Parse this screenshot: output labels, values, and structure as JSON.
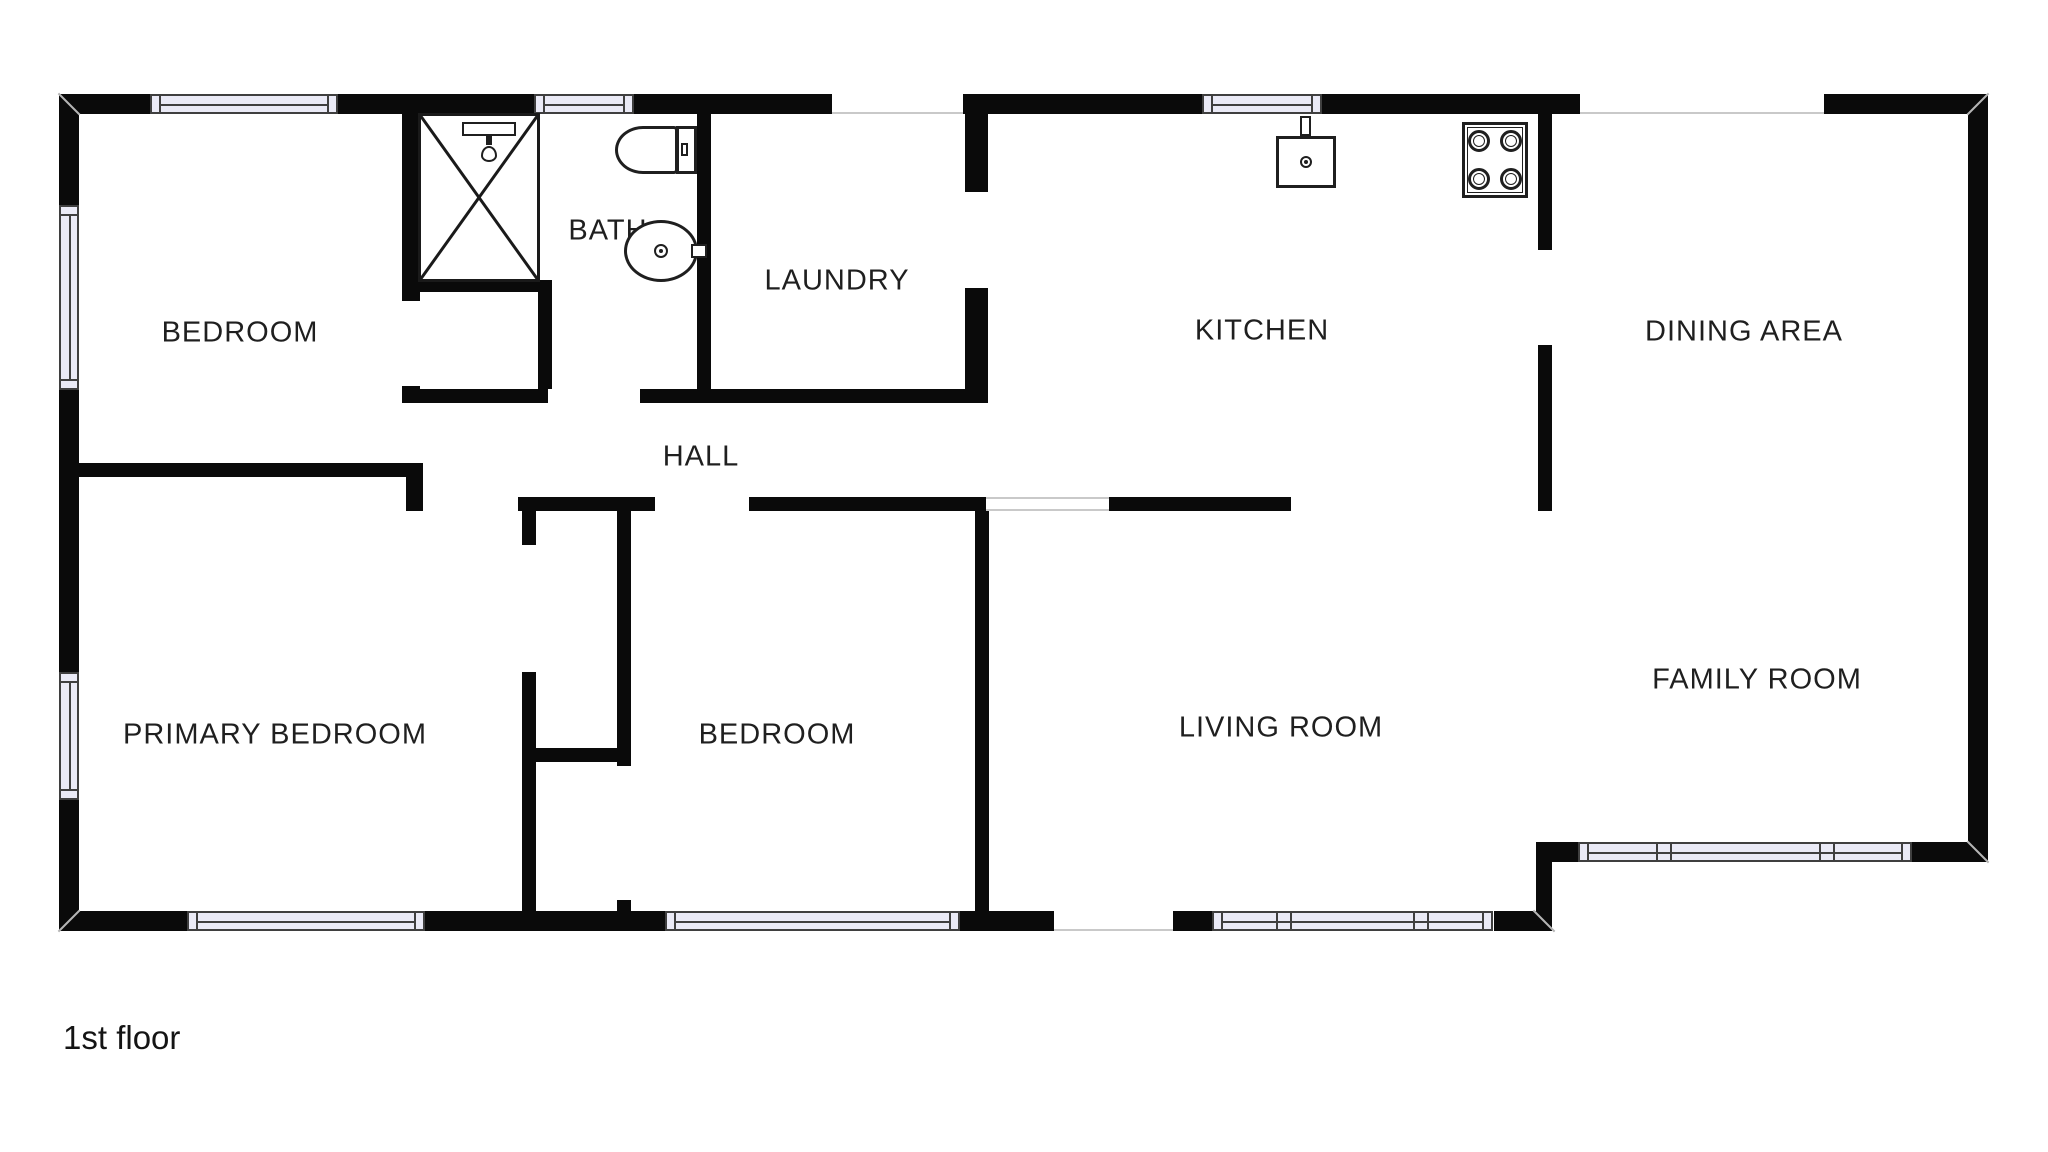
{
  "floor_label": "1st floor",
  "colors": {
    "wall": "#0a0a0a",
    "window_fill": "#eaeaf6",
    "window_border": "#3f3f3f",
    "opening_line": "#c9c9c9",
    "label_text": "#1f1f1f",
    "background": "#ffffff"
  },
  "rooms": {
    "bedroom_top": {
      "label": "BEDROOM",
      "x": 240,
      "y": 333
    },
    "bath": {
      "label": "BATH",
      "x": 608,
      "y": 231
    },
    "laundry": {
      "label": "LAUNDRY",
      "x": 837,
      "y": 281
    },
    "kitchen": {
      "label": "KITCHEN",
      "x": 1262,
      "y": 331
    },
    "dining": {
      "label": "DINING AREA",
      "x": 1744,
      "y": 332
    },
    "hall": {
      "label": "HALL",
      "x": 701,
      "y": 457
    },
    "primary_bedroom": {
      "label": "PRIMARY BEDROOM",
      "x": 275,
      "y": 735
    },
    "bedroom_mid": {
      "label": "BEDROOM",
      "x": 777,
      "y": 735
    },
    "living": {
      "label": "LIVING ROOM",
      "x": 1281,
      "y": 728
    },
    "family": {
      "label": "FAMILY ROOM",
      "x": 1757,
      "y": 680
    }
  },
  "fixtures": {
    "shower": {
      "name": "shower",
      "x": 418,
      "y": 113,
      "w": 122,
      "h": 169
    },
    "shower_head": {
      "name": "shower-head",
      "bar": [
        462,
        122,
        54,
        14
      ],
      "stem": [
        486,
        136,
        6,
        9
      ],
      "drop": [
        489,
        154,
        8
      ]
    },
    "toilet": {
      "name": "toilet",
      "bowl": [
        615,
        126,
        63,
        48
      ],
      "tank": [
        676,
        126,
        21,
        48
      ],
      "handle": [
        681,
        143,
        7,
        13
      ]
    },
    "bathroom_sink": {
      "name": "bathroom-sink",
      "cx": 661,
      "cy": 251,
      "rx": 37,
      "ry": 31,
      "tap": [
        691,
        244,
        16,
        14
      ]
    },
    "kitchen_sink": {
      "name": "kitchen-sink",
      "rect": [
        1276,
        136,
        60,
        52
      ],
      "tap": [
        1300,
        116,
        11,
        20
      ],
      "dot": [
        1306,
        162
      ]
    },
    "stove": {
      "name": "stove",
      "rect": [
        1462,
        122,
        66,
        76
      ],
      "burners": [
        [
          1479,
          141
        ],
        [
          1511,
          141
        ],
        [
          1479,
          179
        ],
        [
          1511,
          179
        ]
      ]
    }
  },
  "geometry": {
    "walls": [
      [
        59,
        94,
        91,
        20
      ],
      [
        338,
        94,
        196,
        20
      ],
      [
        634,
        94,
        198,
        20
      ],
      [
        963,
        94,
        239,
        20
      ],
      [
        1322,
        94,
        258,
        20
      ],
      [
        1824,
        94,
        164,
        20
      ],
      [
        59,
        94,
        20,
        111
      ],
      [
        59,
        390,
        20,
        282
      ],
      [
        59,
        800,
        20,
        131
      ],
      [
        59,
        911,
        128,
        20
      ],
      [
        425,
        911,
        240,
        20
      ],
      [
        960,
        911,
        94,
        20
      ],
      [
        1173,
        911,
        39,
        20
      ],
      [
        1494,
        911,
        58,
        20
      ],
      [
        1968,
        94,
        20,
        768
      ],
      [
        1552,
        842,
        26,
        20
      ],
      [
        1912,
        842,
        76,
        20
      ],
      [
        1536,
        842,
        16,
        89
      ],
      [
        402,
        114,
        18,
        187
      ],
      [
        402,
        386,
        18,
        17
      ],
      [
        402,
        280,
        150,
        12
      ],
      [
        402,
        389,
        146,
        14
      ],
      [
        640,
        389,
        346,
        14
      ],
      [
        538,
        292,
        14,
        97
      ],
      [
        697,
        114,
        14,
        289
      ],
      [
        965,
        114,
        23,
        78
      ],
      [
        965,
        288,
        23,
        115
      ],
      [
        1538,
        114,
        14,
        136
      ],
      [
        1538,
        345,
        14,
        166
      ],
      [
        59,
        463,
        364,
        14
      ],
      [
        406,
        463,
        17,
        48
      ],
      [
        518,
        497,
        137,
        14
      ],
      [
        749,
        497,
        237,
        14
      ],
      [
        1109,
        497,
        182,
        14
      ],
      [
        522,
        511,
        14,
        34
      ],
      [
        522,
        672,
        14,
        239
      ],
      [
        617,
        511,
        14,
        255
      ],
      [
        617,
        900,
        14,
        31
      ],
      [
        522,
        748,
        109,
        14
      ],
      [
        975,
        511,
        14,
        400
      ]
    ],
    "windows": [
      {
        "x": 150,
        "y": 94,
        "len": 188,
        "o": "h"
      },
      {
        "x": 534,
        "y": 94,
        "len": 100,
        "o": "h"
      },
      {
        "x": 1202,
        "y": 94,
        "len": 120,
        "o": "h"
      },
      {
        "x": 187,
        "y": 911,
        "len": 238,
        "o": "h"
      },
      {
        "x": 665,
        "y": 911,
        "len": 295,
        "o": "h"
      },
      {
        "x": 1212,
        "y": 911,
        "len": 281,
        "o": "h",
        "m": [
          70,
          207
        ]
      },
      {
        "x": 1578,
        "y": 842,
        "len": 334,
        "o": "h",
        "m": [
          84,
          247
        ]
      },
      {
        "x": 59,
        "y": 205,
        "len": 185,
        "o": "v"
      },
      {
        "x": 59,
        "y": 672,
        "len": 128,
        "o": "v"
      }
    ],
    "openings": [
      {
        "x": 832,
        "y": 94,
        "w": 131,
        "h": 20,
        "e": [
          "bottom"
        ]
      },
      {
        "x": 1580,
        "y": 94,
        "w": 244,
        "h": 20,
        "e": [
          "bottom"
        ]
      },
      {
        "x": 1054,
        "y": 911,
        "w": 119,
        "h": 20,
        "e": [
          "bottom"
        ]
      },
      {
        "x": 986,
        "y": 497,
        "w": 123,
        "h": 14,
        "e": [
          "top",
          "bottom"
        ]
      }
    ],
    "seams": [
      {
        "x": 69,
        "y": 104,
        "a": 45
      },
      {
        "x": 1978,
        "y": 104,
        "a": -45
      },
      {
        "x": 69,
        "y": 921,
        "a": -45
      },
      {
        "x": 1978,
        "y": 852,
        "a": 45
      },
      {
        "x": 1544,
        "y": 921,
        "a": 45
      }
    ]
  }
}
